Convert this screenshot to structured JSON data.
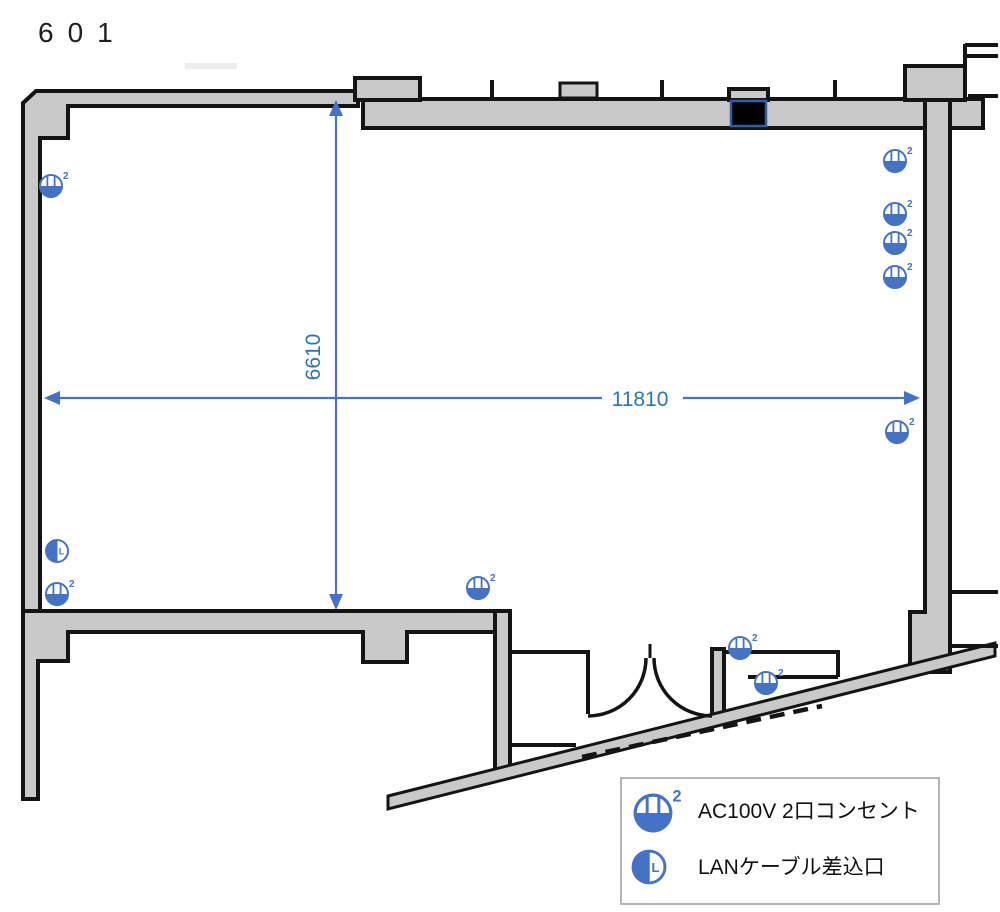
{
  "title": "601",
  "dimensions": {
    "width_label": "11810",
    "height_label": "6610"
  },
  "legend": {
    "items": [
      {
        "symbol": "ac-outlet-2port-icon",
        "label": "AC100V 2口コンセント"
      },
      {
        "symbol": "lan-port-icon",
        "label": "LANケーブル差込口"
      }
    ]
  },
  "symbols": {
    "outlet_marker_superscript": "2",
    "lan_marker_letter": "L",
    "outlets": [
      {
        "x": 51,
        "y": 186
      },
      {
        "x": 895,
        "y": 161
      },
      {
        "x": 895,
        "y": 214
      },
      {
        "x": 895,
        "y": 243
      },
      {
        "x": 895,
        "y": 277
      },
      {
        "x": 897,
        "y": 432
      },
      {
        "x": 57,
        "y": 594
      },
      {
        "x": 478,
        "y": 588
      },
      {
        "x": 740,
        "y": 648
      },
      {
        "x": 766,
        "y": 683
      }
    ],
    "lan": [
      {
        "x": 57,
        "y": 551
      }
    ]
  },
  "colors": {
    "symbol_blue": "#4472c4",
    "dimension_blue": "#2e74b5",
    "wall_fill": "#c9c9c9",
    "wall_outline": "#141414",
    "equipment_black": "#000000"
  }
}
